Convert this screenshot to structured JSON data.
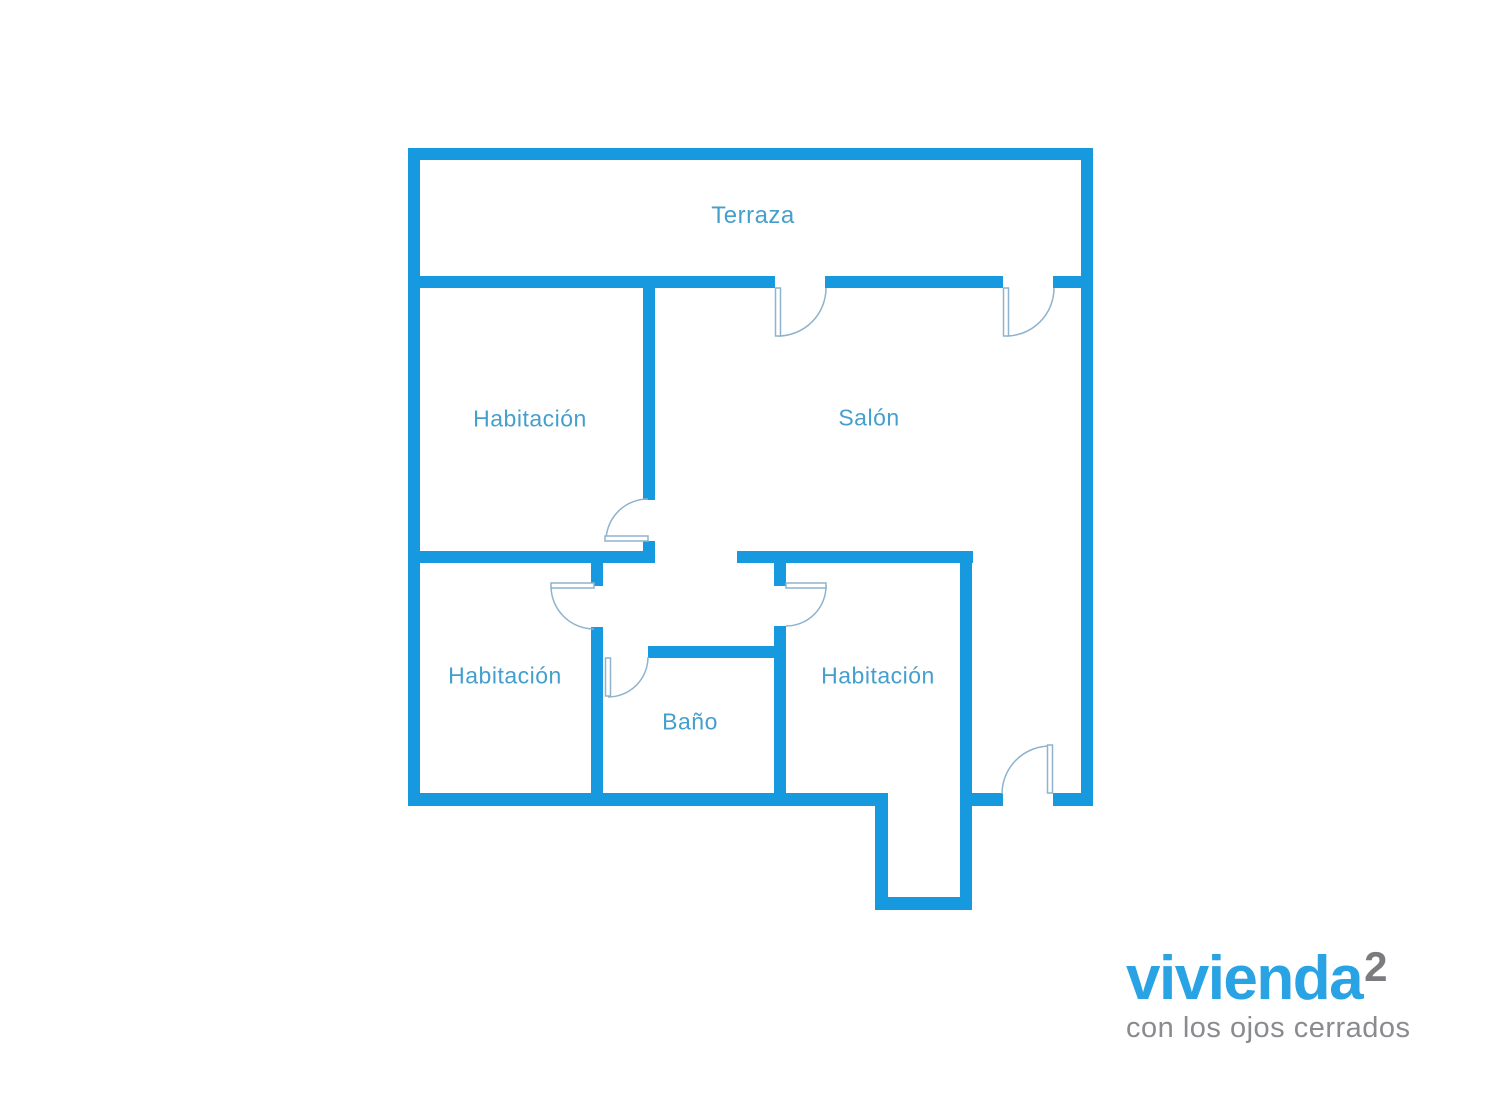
{
  "diagram": {
    "type": "floor-plan",
    "rooms": {
      "terraza": {
        "label": "Terraza"
      },
      "habitacion_top_left": {
        "label": "Habitación"
      },
      "salon": {
        "label": "Salón"
      },
      "habitacion_bottom_left": {
        "label": "Habitación"
      },
      "bano": {
        "label": "Baño"
      },
      "habitacion_bottom_right": {
        "label": "Habitación"
      }
    },
    "colors": {
      "wall": "#1799DF",
      "room_label": "#459FCE",
      "door_line": "#8FB3CC",
      "background": "#FFFFFF"
    },
    "door_count": 7
  },
  "logo": {
    "brand": "vivienda",
    "superscript": "2",
    "tagline": "con los ojos cerrados",
    "colors": {
      "brand": "#29A3E3",
      "superscript": "#7B7C7F",
      "tagline": "#8A8B8E"
    }
  }
}
